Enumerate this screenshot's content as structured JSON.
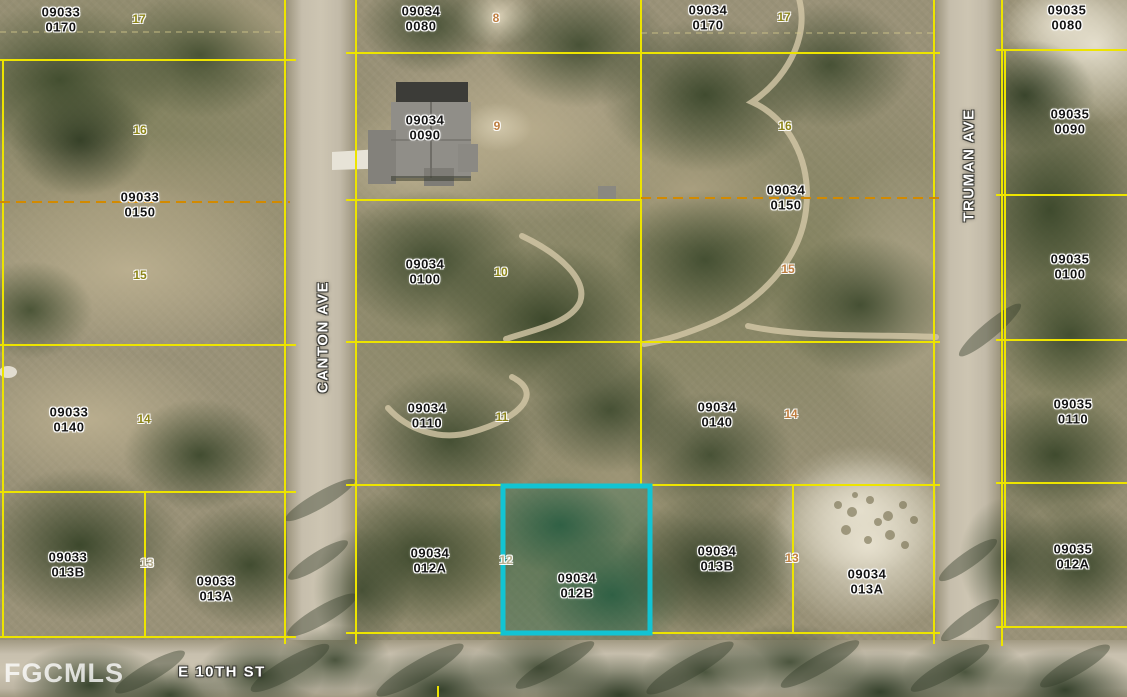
{
  "watermark": "FGCMLS",
  "streets": {
    "canton": "CANTON AVE",
    "truman": "TRUMAN AVE",
    "e10th": "E 10TH ST"
  },
  "highlight": {
    "parcel": "09034 012B",
    "color": "#12c4d3"
  },
  "colors": {
    "parcel_line": "#ede400",
    "parcel_dashed": "#d28a00",
    "highlight": "#12c4d3",
    "lot_olive": "#8c8418",
    "lot_orange": "#bf7e40",
    "lot_pale": "#b5ad8d",
    "street_text": "#ffffff",
    "watermark_text": "#ffffff"
  },
  "parcels": [
    {
      "book": "09033",
      "lot": "0170"
    },
    {
      "book": "09033",
      "lot": "0150"
    },
    {
      "book": "09033",
      "lot": "0140"
    },
    {
      "book": "09033",
      "lot": "013B"
    },
    {
      "book": "09033",
      "lot": "013A"
    },
    {
      "book": "09034",
      "lot": "0080"
    },
    {
      "book": "09034",
      "lot": "0170"
    },
    {
      "book": "09034",
      "lot": "0090"
    },
    {
      "book": "09034",
      "lot": "0150"
    },
    {
      "book": "09034",
      "lot": "0100"
    },
    {
      "book": "09034",
      "lot": "0110"
    },
    {
      "book": "09034",
      "lot": "0140"
    },
    {
      "book": "09034",
      "lot": "012A"
    },
    {
      "book": "09034",
      "lot": "012B"
    },
    {
      "book": "09034",
      "lot": "013B"
    },
    {
      "book": "09034",
      "lot": "013A"
    },
    {
      "book": "09035",
      "lot": "0080"
    },
    {
      "book": "09035",
      "lot": "0090"
    },
    {
      "book": "09035",
      "lot": "0100"
    },
    {
      "book": "09035",
      "lot": "0110"
    },
    {
      "book": "09035",
      "lot": "012A"
    }
  ],
  "lot_numbers": [
    {
      "n": "17",
      "tone": "olive"
    },
    {
      "n": "16",
      "tone": "olive"
    },
    {
      "n": "15",
      "tone": "olive"
    },
    {
      "n": "14",
      "tone": "olive"
    },
    {
      "n": "13",
      "tone": "pale"
    },
    {
      "n": "8",
      "tone": "orange"
    },
    {
      "n": "9",
      "tone": "orange"
    },
    {
      "n": "10",
      "tone": "olive"
    },
    {
      "n": "11",
      "tone": "olive"
    },
    {
      "n": "12",
      "tone": "pale"
    },
    {
      "n": "17",
      "tone": "olive"
    },
    {
      "n": "16",
      "tone": "olive"
    },
    {
      "n": "15",
      "tone": "orange"
    },
    {
      "n": "14",
      "tone": "orange"
    },
    {
      "n": "13",
      "tone": "orange"
    }
  ]
}
